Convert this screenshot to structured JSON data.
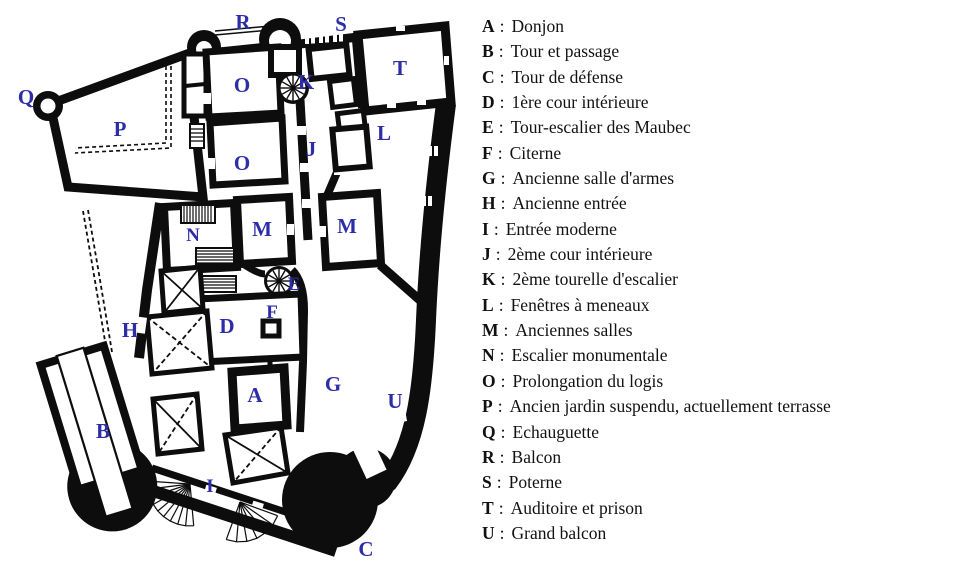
{
  "plan": {
    "letters": {
      "A": "A",
      "B": "B",
      "C": "C",
      "D": "D",
      "E": "E",
      "F": "F",
      "G": "G",
      "H": "H",
      "I": "I",
      "J": "J",
      "K": "K",
      "L": "L",
      "M": "M",
      "N": "N",
      "O": "O",
      "P": "P",
      "Q": "Q",
      "R": "R",
      "S": "S",
      "T": "T",
      "U": "U"
    }
  },
  "legend": {
    "separator": ":",
    "items": [
      {
        "key": "A",
        "label": "Donjon"
      },
      {
        "key": "B",
        "label": "Tour et passage"
      },
      {
        "key": "C",
        "label": "Tour de défense"
      },
      {
        "key": "D",
        "label": "1ère cour intérieure"
      },
      {
        "key": "E",
        "label": "Tour-escalier des Maubec"
      },
      {
        "key": "F",
        "label": "Citerne"
      },
      {
        "key": "G",
        "label": "Ancienne salle d'armes"
      },
      {
        "key": "H",
        "label": "Ancienne entrée"
      },
      {
        "key": "I",
        "label": "Entrée moderne"
      },
      {
        "key": "J",
        "label": "2ème cour intérieure"
      },
      {
        "key": "K",
        "label": "2ème tourelle d'escalier"
      },
      {
        "key": "L",
        "label": "Fenêtres à meneaux"
      },
      {
        "key": "M",
        "label": "Anciennes salles"
      },
      {
        "key": "N",
        "label": "Escalier monumentale"
      },
      {
        "key": "O",
        "label": "Prolongation du logis"
      },
      {
        "key": "P",
        "label": "Ancien jardin suspendu, actuellement terrasse"
      },
      {
        "key": "Q",
        "label": "Echauguette"
      },
      {
        "key": "R",
        "label": "Balcon"
      },
      {
        "key": "S",
        "label": "Poterne"
      },
      {
        "key": "T",
        "label": "Auditoire et prison"
      },
      {
        "key": "U",
        "label": "Grand balcon"
      }
    ]
  },
  "colors": {
    "marker_blue": "#2d2da8",
    "wall_black": "#0d0d0d",
    "background": "#ffffff"
  }
}
